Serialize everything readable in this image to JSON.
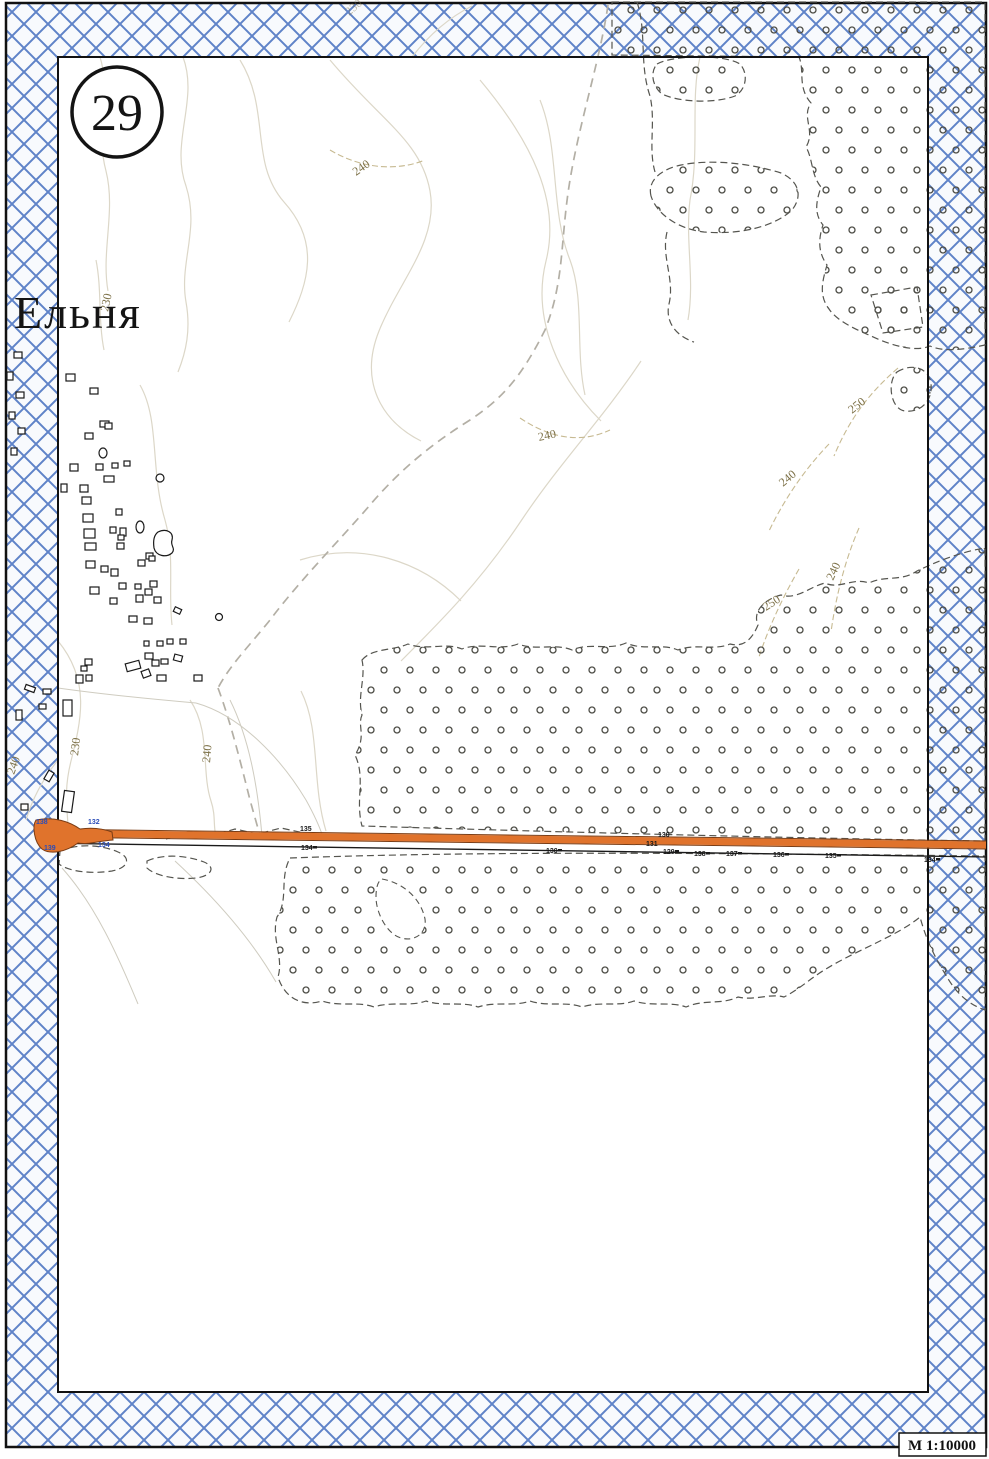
{
  "sheet": {
    "number": "29",
    "title": "Ельня",
    "scale_label": "М 1:10000"
  },
  "colors": {
    "band_blue": "#5f83c8",
    "band_bg": "#f8fafd",
    "road_orange": "#e0732c",
    "road_edge_brown": "#7a3c14",
    "stipple_dark": "#4c4c45",
    "dash_boundary": "#55554f",
    "contour": "#dcd7c8",
    "contour_dashed": "#c7ba92",
    "track_gray": "#b3afa5",
    "thin_gray": "#cfccc0",
    "label_brown": "#7d7148",
    "blue_label": "#2b4db8",
    "black": "#1a1a1a",
    "frame_black": "#111111"
  },
  "map": {
    "contours": [
      {
        "d": "M183,57 C199,100 170,142 186,186 C200,230 179,262 186,302 C191,330 186,352 178,372"
      },
      {
        "d": "M240,60 C271,110 249,162 284,202 C320,242 309,282 289,322"
      },
      {
        "d": "M330,60 C381,121 421,141 430,191 C439,241 399,281 379,331 C359,381 381,421 421,441"
      },
      {
        "d": "M480,80 C531,141 561,201 546,261 C531,321 561,381 601,421"
      },
      {
        "d": "M641,361 C601,421 561,461 521,521 C481,581 441,621 401,661"
      },
      {
        "d": "M100,57 C111,91 95,131 106,171 C116,211 101,251 108,291"
      },
      {
        "d": "M58,641 C91,681 81,721 71,761 C61,801 71,821 67,836"
      },
      {
        "d": "M190,700 C211,731 201,771 211,801 C216,816 213,826 216,836"
      },
      {
        "d": "M58,760 C42,780 32,800 26,820"
      },
      {
        "d": "M301,691 C321,731 311,781 326,831"
      },
      {
        "d": "M412,57 C432,31 452,16 472,6"
      },
      {
        "d": "M300,560 C361,541 421,561 461,601"
      },
      {
        "d": "M140,385 C160,420 150,470 165,520 C175,555 168,590 172,625"
      },
      {
        "d": "M700,57 C690,100 700,150 690,200 C685,240 695,280 688,320"
      },
      {
        "d": "M540,100 C560,150 550,210 570,260 C585,300 575,350 585,395"
      },
      {
        "d": "M96,260 C102,290 98,320 104,350"
      },
      {
        "d": "M898,368 C868,394 849,420 834,456",
        "dashed": true
      },
      {
        "d": "M829,444 C804,470 784,500 769,531",
        "dashed": true
      },
      {
        "d": "M859,528 C845,560 836,596 831,632",
        "dashed": true
      },
      {
        "d": "M799,569 C784,595 769,626 759,657",
        "dashed": true
      },
      {
        "d": "M520,418 C550,438 580,444 610,430",
        "dashed": true
      },
      {
        "d": "M330,150 C360,168 395,172 425,160",
        "dashed": true
      }
    ],
    "tracks": [
      "M608,5 C600,60 580,120 570,180 C560,240 565,280 545,330 C520,380 500,400 470,420 C430,445 400,470 370,505 C340,540 300,580 270,620 C250,645 230,665 218,688",
      "M218,688 C230,720 240,760 250,800 C255,818 258,828 260,836"
    ],
    "thin_lines": [
      "M58,688 C100,694 150,699 196,703",
      "M196,703 C242,716 282,760 306,800 C316,818 320,828 323,837",
      "M230,700 C250,740 258,790 262,836",
      "M175,861 C215,898 252,940 276,982",
      "M62,868 C96,906 118,956 138,1004"
    ],
    "stipple_regions": [
      "M612,2 L985,2 L985,345 C962,350 944,352 930,346 C914,353 888,344 871,336 C855,329 837,321 829,309 C818,295 823,279 827,265 C817,251 819,237 823,225 C813,213 817,199 821,187 C811,175 813,159 806,147 C816,131 801,117 811,103 C797,87 805,71 799,57 L612,55 Z",
      "M657,64 C673,55 724,54 740,64 C749,74 746,90 735,96 C714,104 678,102 662,94 C652,86 650,72 657,64 Z",
      "M651,196 C647,180 662,169 681,165 C711,159 749,163 781,173 C799,181 803,196 792,210 C774,227 739,235 704,232 C679,229 657,215 651,196 Z",
      "M871,295 L917,287 L923,327 L883,333 Z",
      "M897,372 C911,363 929,367 931,384 C933,401 920,413 905,411 C890,409 887,381 897,372 Z",
      "M362,660 C372,648 392,651 408,644 C426,651 446,642 462,649 C480,642 500,651 518,644 C536,651 556,643 572,650 C590,642 608,651 626,643 C644,651 662,643 678,650 C696,643 714,651 730,644 C745,648 753,637 758,625 C752,611 765,599 781,595 C797,600 809,587 825,583 C839,590 853,577 869,583 C885,575 901,582 917,571 C936,562 960,552 985,548 L985,841 C780,838 560,832 362,826 C355,800 366,778 355,755 C367,736 357,726 362,715 C357,696 366,678 362,660 Z",
      "M290,858 C480,851 700,853 985,856 L985,1010 C967,1004 955,991 947,977 C937,961 927,943 920,917 C908,927 892,935 876,943 C860,951 842,959 826,969 C812,977 800,989 784,997 C770,993 754,1001 738,997 C722,1005 704,999 686,1007 C670,1001 652,1007 634,1001 C618,1007 600,1001 582,1007 C566,1001 548,1007 530,1001 C514,1007 496,1001 478,1007 C462,1001 444,1007 426,1001 C410,1007 392,1001 374,1007 C358,1001 340,1007 322,1001 C303,1007 285,999 278,977 C284,957 271,939 277,917 C289,899 279,879 290,858 Z"
    ],
    "stipple_holes": [
      "M382,879 C404,883 421,899 425,919 C427,933 415,942 401,938 C387,934 376,913 376,897 C376,887 378,881 382,879 Z"
    ],
    "dashed_paths": [
      "M637,2 C647,32 639,64 650,96 C656,122 648,148 655,172",
      "M667,232 C661,257 675,279 669,304 C665,322 676,336 694,342",
      "M60,851 C79,843 102,845 118,852 C132,858 128,868 112,871 C93,874 69,872 59,864 Z",
      "M147,861 C165,853 188,856 204,862 C216,867 212,876 196,878 C177,880 155,876 147,868 Z",
      "M166,839 L189,831 L212,836 L235,829 L258,834 L281,828 L304,833"
    ],
    "road": {
      "junction": "M36,820 C54,816 70,822 80,829 C94,827 104,829 112,832 L113,840 C98,841 88,845 78,843 C66,852 50,855 42,849 C34,842 32,826 36,820 Z",
      "band": "M38,833 L986,845",
      "casing_top": "M38,829 L986,841",
      "casing_bottom": "M38,837 L986,849",
      "lower_line": "M38,843 L986,857"
    },
    "road_labels": {
      "blue": [
        {
          "t": "138",
          "x": 36,
          "y": 824
        },
        {
          "t": "132",
          "x": 88,
          "y": 824
        },
        {
          "t": "139",
          "x": 44,
          "y": 850
        },
        {
          "t": "134",
          "x": 98,
          "y": 847
        }
      ],
      "black": [
        {
          "t": "135",
          "x": 300,
          "y": 831
        },
        {
          "t": "130",
          "x": 658,
          "y": 837
        },
        {
          "t": "131",
          "x": 646,
          "y": 846
        },
        {
          "t": "134",
          "x": 301,
          "y": 850,
          "tick": true
        },
        {
          "t": "130",
          "x": 546,
          "y": 853,
          "tick": true
        },
        {
          "t": "129",
          "x": 663,
          "y": 854,
          "tick": true
        },
        {
          "t": "138",
          "x": 694,
          "y": 856,
          "tick": true
        },
        {
          "t": "137",
          "x": 726,
          "y": 856,
          "tick": true
        },
        {
          "t": "136",
          "x": 773,
          "y": 857,
          "tick": true
        },
        {
          "t": "135",
          "x": 825,
          "y": 858,
          "tick": true
        },
        {
          "t": "134",
          "x": 924,
          "y": 862,
          "tick": true
        }
      ]
    },
    "buildings": [
      [
        14,
        352,
        8,
        6,
        0
      ],
      [
        7,
        372,
        6,
        8,
        0
      ],
      [
        16,
        392,
        8,
        6,
        0
      ],
      [
        9,
        412,
        6,
        7,
        0
      ],
      [
        18,
        428,
        7,
        6,
        0
      ],
      [
        11,
        448,
        6,
        7,
        0
      ],
      [
        25,
        686,
        10,
        5,
        20
      ],
      [
        43,
        689,
        8,
        5,
        0
      ],
      [
        16,
        710,
        6,
        10,
        0
      ],
      [
        39,
        704,
        7,
        5,
        0
      ],
      [
        46,
        771,
        6,
        10,
        30
      ],
      [
        21,
        804,
        7,
        6,
        0
      ],
      [
        66,
        374,
        9,
        7,
        0
      ],
      [
        90,
        388,
        8,
        6,
        0
      ],
      [
        100,
        421,
        9,
        6,
        0
      ],
      [
        85,
        433,
        8,
        6,
        0
      ],
      [
        105,
        423,
        7,
        6,
        0
      ],
      [
        70,
        464,
        8,
        7,
        0
      ],
      [
        96,
        464,
        7,
        6,
        0
      ],
      [
        112,
        463,
        6,
        5,
        0
      ],
      [
        124,
        461,
        6,
        5,
        0
      ],
      [
        104,
        476,
        10,
        6,
        0
      ],
      [
        61,
        484,
        6,
        8,
        0
      ],
      [
        80,
        485,
        8,
        7,
        0
      ],
      [
        82,
        497,
        9,
        7,
        0
      ],
      [
        83,
        514,
        10,
        8,
        0
      ],
      [
        116,
        509,
        6,
        6,
        0
      ],
      [
        84,
        529,
        11,
        9,
        0
      ],
      [
        110,
        527,
        6,
        6,
        0
      ],
      [
        120,
        528,
        6,
        8,
        0
      ],
      [
        118,
        535,
        6,
        5,
        0
      ],
      [
        85,
        543,
        11,
        7,
        0
      ],
      [
        117,
        543,
        7,
        6,
        0
      ],
      [
        86,
        561,
        9,
        7,
        0
      ],
      [
        101,
        566,
        7,
        6,
        0
      ],
      [
        111,
        569,
        7,
        7,
        0
      ],
      [
        146,
        553,
        7,
        6,
        0
      ],
      [
        138,
        560,
        7,
        6,
        0
      ],
      [
        149,
        556,
        6,
        5,
        0
      ],
      [
        90,
        587,
        9,
        7,
        0
      ],
      [
        119,
        583,
        7,
        6,
        0
      ],
      [
        135,
        584,
        6,
        5,
        0
      ],
      [
        150,
        581,
        7,
        6,
        0
      ],
      [
        145,
        589,
        7,
        6,
        0
      ],
      [
        110,
        598,
        7,
        6,
        0
      ],
      [
        136,
        595,
        7,
        7,
        0
      ],
      [
        154,
        597,
        7,
        6,
        0
      ],
      [
        174,
        608,
        7,
        5,
        25
      ],
      [
        129,
        616,
        8,
        6,
        0
      ],
      [
        144,
        618,
        8,
        6,
        0
      ],
      [
        144,
        641,
        5,
        5,
        0
      ],
      [
        157,
        641,
        6,
        5,
        0
      ],
      [
        167,
        639,
        6,
        5,
        0
      ],
      [
        180,
        639,
        6,
        5,
        0
      ],
      [
        85,
        659,
        7,
        6,
        0
      ],
      [
        81,
        666,
        6,
        5,
        0
      ],
      [
        76,
        675,
        7,
        8,
        0
      ],
      [
        86,
        675,
        6,
        6,
        0
      ],
      [
        126,
        662,
        14,
        8,
        -15
      ],
      [
        145,
        653,
        8,
        6,
        0
      ],
      [
        152,
        660,
        7,
        6,
        0
      ],
      [
        161,
        659,
        7,
        5,
        0
      ],
      [
        174,
        655,
        8,
        6,
        15
      ],
      [
        142,
        670,
        8,
        7,
        -20
      ],
      [
        157,
        675,
        9,
        6,
        0
      ],
      [
        194,
        675,
        8,
        6,
        0
      ],
      [
        63,
        700,
        9,
        16,
        0
      ],
      [
        63,
        791,
        10,
        21,
        8
      ]
    ],
    "ovals": [
      [
        103,
        453,
        8,
        10
      ],
      [
        140,
        527,
        8,
        12
      ],
      [
        160,
        478,
        8,
        8
      ],
      [
        219,
        617,
        7,
        7
      ]
    ],
    "blob_paths": [
      "M158,532 C166,528 174,532 172,540 C170,546 176,548 172,553 C166,558 156,556 154,548 C153,541 154,535 158,532 Z"
    ],
    "contour_labels": [
      {
        "t": "230",
        "x": 349,
        "y": 16,
        "r": -40,
        "faint": true
      },
      {
        "t": "240",
        "x": 356,
        "y": 176,
        "r": -35
      },
      {
        "t": "230",
        "x": 108,
        "y": 312,
        "r": -78
      },
      {
        "t": "240",
        "x": 539,
        "y": 441,
        "r": -12
      },
      {
        "t": "250",
        "x": 852,
        "y": 414,
        "r": -38
      },
      {
        "t": "240",
        "x": 783,
        "y": 487,
        "r": -40
      },
      {
        "t": "240",
        "x": 833,
        "y": 581,
        "r": -65
      },
      {
        "t": "250",
        "x": 766,
        "y": 611,
        "r": -33
      },
      {
        "t": "230",
        "x": 78,
        "y": 756,
        "r": -83
      },
      {
        "t": "240",
        "x": 14,
        "y": 775,
        "r": -70
      },
      {
        "t": "240",
        "x": 210,
        "y": 763,
        "r": -85
      }
    ]
  }
}
